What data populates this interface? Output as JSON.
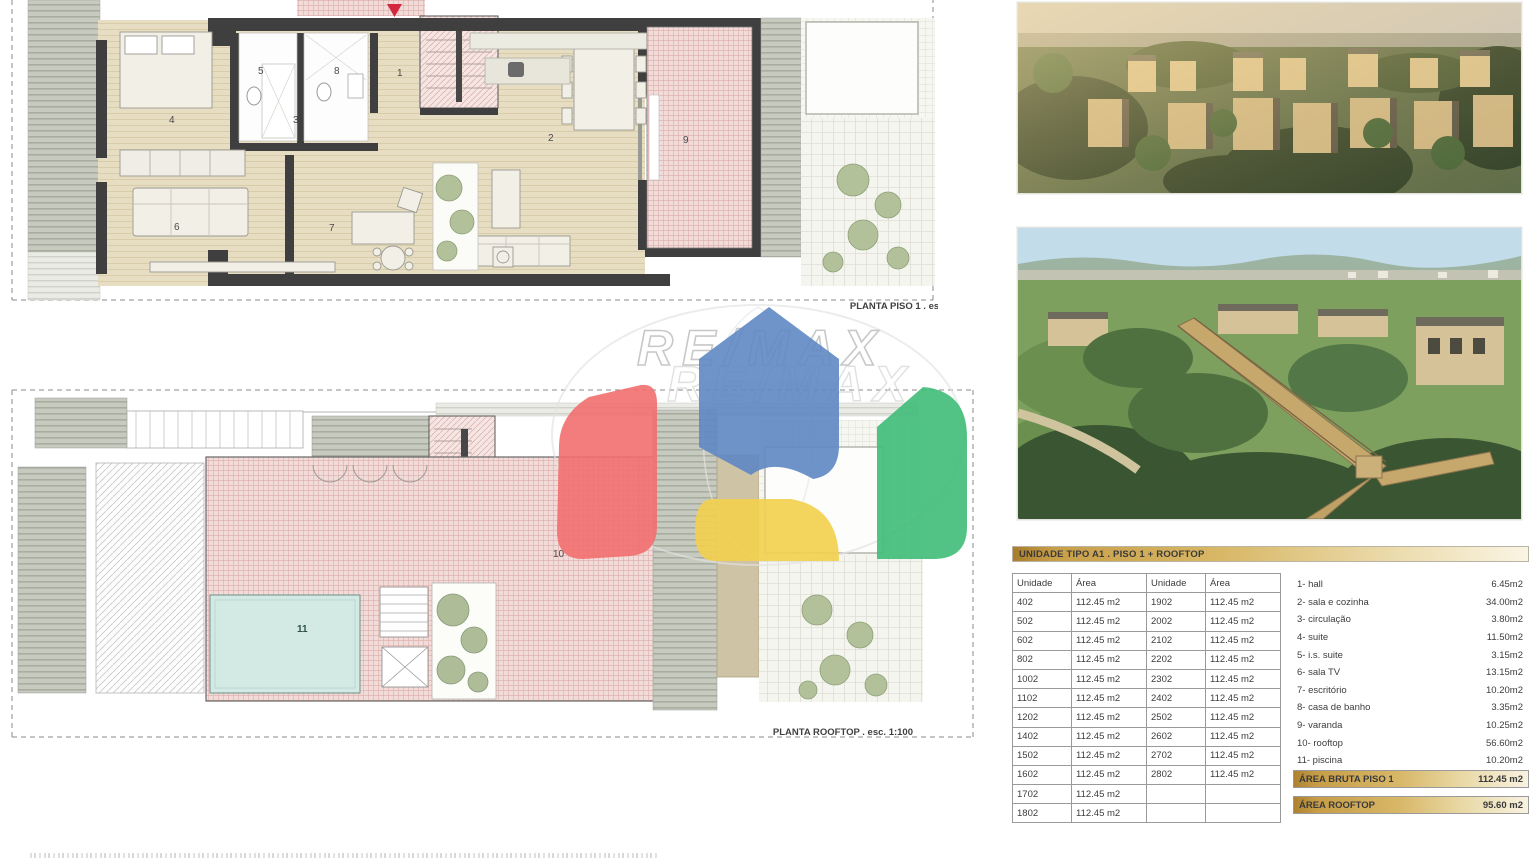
{
  "watermark": {
    "brand": "RE/MAX"
  },
  "plans": {
    "piso1": {
      "caption": "PLANTA PISO 1  .  esc. 1:100",
      "rooms": [
        "1",
        "2",
        "3",
        "4",
        "5",
        "6",
        "7",
        "8",
        "9"
      ]
    },
    "rooftop": {
      "caption": "PLANTA ROOFTOP  .  esc. 1:100",
      "rooms": [
        "10",
        "11"
      ]
    }
  },
  "unit_table": {
    "title": "UNIDADE TIPO A1 . PISO 1 + ROOFTOP",
    "headers": [
      "Unidade",
      "Área",
      "Unidade",
      "Área"
    ],
    "rows": [
      [
        "402",
        "112.45 m2",
        "1902",
        "112.45 m2"
      ],
      [
        "502",
        "112.45 m2",
        "2002",
        "112.45 m2"
      ],
      [
        "602",
        "112.45 m2",
        "2102",
        "112.45 m2"
      ],
      [
        "802",
        "112.45 m2",
        "2202",
        "112.45 m2"
      ],
      [
        "1002",
        "112.45 m2",
        "2302",
        "112.45 m2"
      ],
      [
        "1102",
        "112.45 m2",
        "2402",
        "112.45 m2"
      ],
      [
        "1202",
        "112.45 m2",
        "2502",
        "112.45 m2"
      ],
      [
        "1402",
        "112.45 m2",
        "2602",
        "112.45 m2"
      ],
      [
        "1502",
        "112.45 m2",
        "2702",
        "112.45 m2"
      ],
      [
        "1602",
        "112.45 m2",
        "2802",
        "112.45 m2"
      ],
      [
        "1702",
        "112.45 m2",
        "",
        ""
      ],
      [
        "1802",
        "112.45 m2",
        "",
        ""
      ]
    ]
  },
  "room_legend": {
    "items": [
      {
        "label": "1- hall",
        "area": "6.45m2"
      },
      {
        "label": "2- sala e cozinha",
        "area": "34.00m2"
      },
      {
        "label": "3- circulação",
        "area": "3.80m2"
      },
      {
        "label": "4- suite",
        "area": "11.50m2"
      },
      {
        "label": "5- i.s. suite",
        "area": "3.15m2"
      },
      {
        "label": "6- sala TV",
        "area": "13.15m2"
      },
      {
        "label": "7- escritório",
        "area": "10.20m2"
      },
      {
        "label": "8- casa de banho",
        "area": "3.35m2"
      },
      {
        "label": "9- varanda",
        "area": "10.25m2"
      },
      {
        "label": "10- rooftop",
        "area": "56.60m2"
      },
      {
        "label": "11- piscina",
        "area": "10.20m2"
      }
    ]
  },
  "totals": [
    {
      "label": "ÁREA BRUTA PISO 1",
      "value": "112.45 m2"
    },
    {
      "label": "ÁREA ROOFTOP",
      "value": "95.60 m2"
    }
  ],
  "colors": {
    "gold_dark": "#ad8230",
    "gold_light": "#f8f2e0",
    "remax_red": "#f26f6f",
    "remax_blue": "#5e88c4",
    "remax_yellow": "#f3d14e",
    "remax_green": "#3fbd78",
    "plan_floor": "#e7ddc2",
    "plan_wall": "#3f3f3f",
    "plan_tile_pink": "#f2dcd9",
    "pool_blue": "#d3e9e4"
  }
}
